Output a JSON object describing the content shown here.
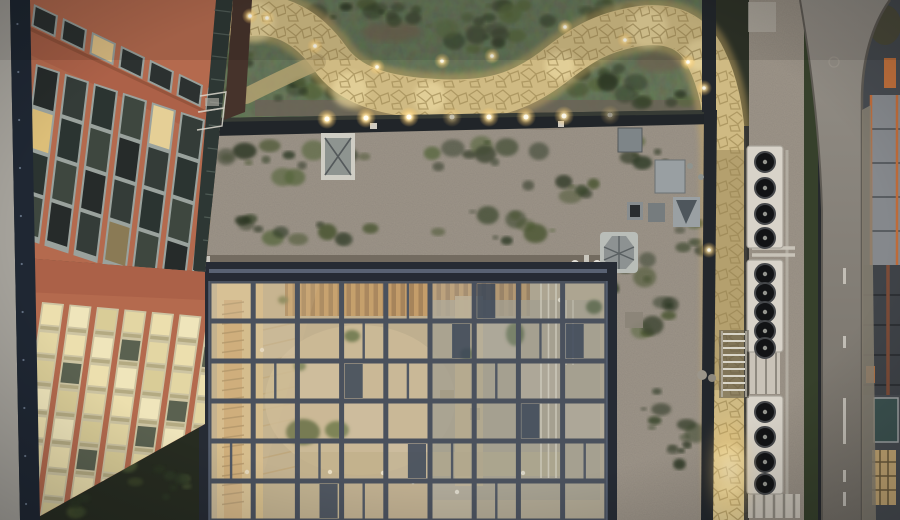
{
  "meta": {
    "title": "Aerial dusk photograph of rooftop courtyard building",
    "description": "Top-down drone view: terracotta facade at left, glass atrium roof over courtyard, green roof with winding illuminated stone path, rooftop HVAC fan units, street and neighbouring construction at right"
  },
  "palette": {
    "facade": "#b46a4e",
    "facade_band": "#ab6148",
    "facade_fascia": "#a25c40",
    "garden_base": "#3b4231",
    "gravel": "#6f675c",
    "path_base": "#cfba83",
    "path_glow": "#c8a863",
    "roof_edge": "#212529",
    "atrium_frame": "#262b34",
    "atrium_mullion": "#4a515d",
    "glass_base": "#b5aa91",
    "hvac_cabinet": "#d8d3c9",
    "hedge": "#36402b",
    "road": "#8b8680",
    "navy_band": "#1f2733",
    "sidewalk": "#a5a29b",
    "veg": [
      "#2b3422",
      "#39452a",
      "#46532f",
      "#55653a",
      "#3c4430",
      "#2f3a26"
    ]
  },
  "scene": {
    "path": {
      "main": "M 240,18 C 280,8 310,30 330,58 C 348,84 380,96 435,99 C 490,102 520,92 552,68 C 580,46 600,32 640,26 C 672,22 694,32 706,58 C 718,82 724,110 726,150 L 727,300 C 727,380 728,450 730,520",
      "branch": "M 246,96 C 270,84 295,72 318,62",
      "pools": [
        [
          255,
          22,
          20
        ],
        [
          350,
          90,
          18
        ],
        [
          430,
          97,
          16
        ],
        [
          560,
          66,
          15
        ],
        [
          648,
          28,
          20
        ],
        [
          700,
          55,
          16
        ],
        [
          728,
          470,
          24
        ],
        [
          730,
          505,
          20
        ]
      ]
    },
    "garden": {
      "veg_clusters": [
        [
          360,
          18,
          70,
          14,
          12
        ],
        [
          500,
          14,
          60,
          12,
          10
        ],
        [
          620,
          12,
          50,
          12,
          9
        ],
        [
          300,
          90,
          50,
          14,
          9
        ],
        [
          470,
          38,
          65,
          16,
          11
        ],
        [
          590,
          78,
          55,
          16,
          10
        ],
        [
          660,
          92,
          38,
          13,
          8
        ],
        [
          300,
          160,
          80,
          18,
          14
        ],
        [
          480,
          155,
          70,
          15,
          10
        ],
        [
          300,
          228,
          80,
          16,
          12
        ],
        [
          500,
          226,
          70,
          16,
          11
        ],
        [
          560,
          190,
          40,
          12,
          7
        ],
        [
          650,
          150,
          30,
          15,
          7
        ],
        [
          640,
          300,
          35,
          42,
          14
        ],
        [
          670,
          425,
          30,
          50,
          14
        ],
        [
          692,
          240,
          14,
          25,
          6
        ],
        [
          150,
          480,
          45,
          25,
          10
        ],
        [
          62,
          502,
          30,
          15,
          6
        ],
        [
          810,
          150,
          6,
          80,
          16
        ],
        [
          810,
          400,
          6,
          70,
          14
        ],
        [
          810,
          60,
          6,
          40,
          9
        ],
        [
          240,
          62,
          10,
          40,
          10
        ]
      ],
      "dirt_patches": [
        [
          300,
          22,
          35,
          12
        ],
        [
          392,
          32,
          30,
          10
        ],
        [
          660,
          62,
          25,
          10
        ],
        [
          545,
          120,
          30,
          8
        ]
      ]
    },
    "lights": {
      "edge": [
        [
          327,
          119,
          1
        ],
        [
          366,
          118,
          1
        ],
        [
          409,
          117,
          1
        ],
        [
          452,
          117,
          0.5
        ],
        [
          489,
          117,
          0.9
        ],
        [
          526,
          117,
          0.9
        ],
        [
          564,
          116,
          0.85
        ],
        [
          610,
          115,
          0.35
        ]
      ],
      "path": [
        [
          250,
          16,
          1
        ],
        [
          267,
          18,
          0.8
        ],
        [
          315,
          46,
          0.9
        ],
        [
          377,
          67,
          0.8
        ],
        [
          442,
          61,
          0.8
        ],
        [
          492,
          56,
          0.8
        ],
        [
          565,
          27,
          0.8
        ],
        [
          625,
          40,
          0.8
        ],
        [
          688,
          62,
          0.9
        ],
        [
          704,
          88,
          0.8
        ],
        [
          709,
          250,
          0.8
        ]
      ]
    },
    "atrium": {
      "x0": 209,
      "y0": 281,
      "cols": 9,
      "rows": 6,
      "cw": 44.2,
      "ch": 40,
      "split": [
        [
          1,
          2
        ],
        [
          3,
          1
        ],
        [
          4,
          2
        ],
        [
          6,
          2
        ],
        [
          2,
          4
        ],
        [
          5,
          4
        ],
        [
          7,
          1
        ],
        [
          8,
          4
        ],
        [
          3,
          5
        ],
        [
          6,
          5
        ],
        [
          0,
          4
        ],
        [
          4,
          0
        ]
      ],
      "dark_half": [
        [
          3,
          2,
          "L"
        ],
        [
          5,
          1,
          "R"
        ],
        [
          7,
          3,
          "L"
        ],
        [
          4,
          4,
          "R"
        ],
        [
          8,
          1,
          "L"
        ],
        [
          2,
          5,
          "R"
        ],
        [
          6,
          0,
          "L"
        ]
      ],
      "white_dots": [
        [
          247,
          472
        ],
        [
          330,
          472
        ],
        [
          383,
          473
        ],
        [
          413,
          482
        ],
        [
          523,
          473
        ],
        [
          457,
          492
        ],
        [
          560,
          300
        ],
        [
          262,
          350
        ]
      ]
    },
    "facade": {
      "upper": {
        "cols": 7,
        "pitch": 29,
        "rows": 4,
        "rpitch": 42,
        "lit": [
          [
            0,
            1,
            "#dcbe78"
          ],
          [
            4,
            0,
            "#e5cf96"
          ],
          [
            6,
            2,
            "#caa863"
          ],
          [
            3,
            3,
            "#8a7a55"
          ]
        ],
        "lit_small_col": 2
      },
      "lower": {
        "cols": 7,
        "pitch": 27.5,
        "rows": 8,
        "rpitch": 28,
        "dark": [
          [
            1,
            2
          ],
          [
            3,
            1
          ],
          [
            5,
            3
          ],
          [
            2,
            5
          ],
          [
            6,
            1
          ],
          [
            0,
            6
          ],
          [
            4,
            4
          ],
          [
            6,
            5
          ]
        ]
      }
    },
    "hvac": {
      "fan_r": 10,
      "units": [
        {
          "x": 747,
          "y": 146,
          "w": 36,
          "h": 102,
          "cys": [
            162,
            188,
            214,
            238
          ]
        },
        {
          "x": 747,
          "y": 260,
          "w": 36,
          "h": 92,
          "cys": [
            274,
            293,
            312,
            331,
            348
          ]
        },
        {
          "x": 747,
          "y": 396,
          "w": 36,
          "h": 98,
          "cys": [
            412,
            437,
            462,
            484
          ]
        }
      ]
    },
    "road": {
      "dash_x": 843,
      "dashes": [
        [
          268,
          16
        ],
        [
          336,
          12
        ],
        [
          398,
          46
        ],
        [
          470,
          12
        ],
        [
          492,
          14
        ]
      ]
    },
    "stairs": {
      "x": 723,
      "w": 22,
      "y0": 334,
      "n": 9,
      "dy": 7
    }
  }
}
